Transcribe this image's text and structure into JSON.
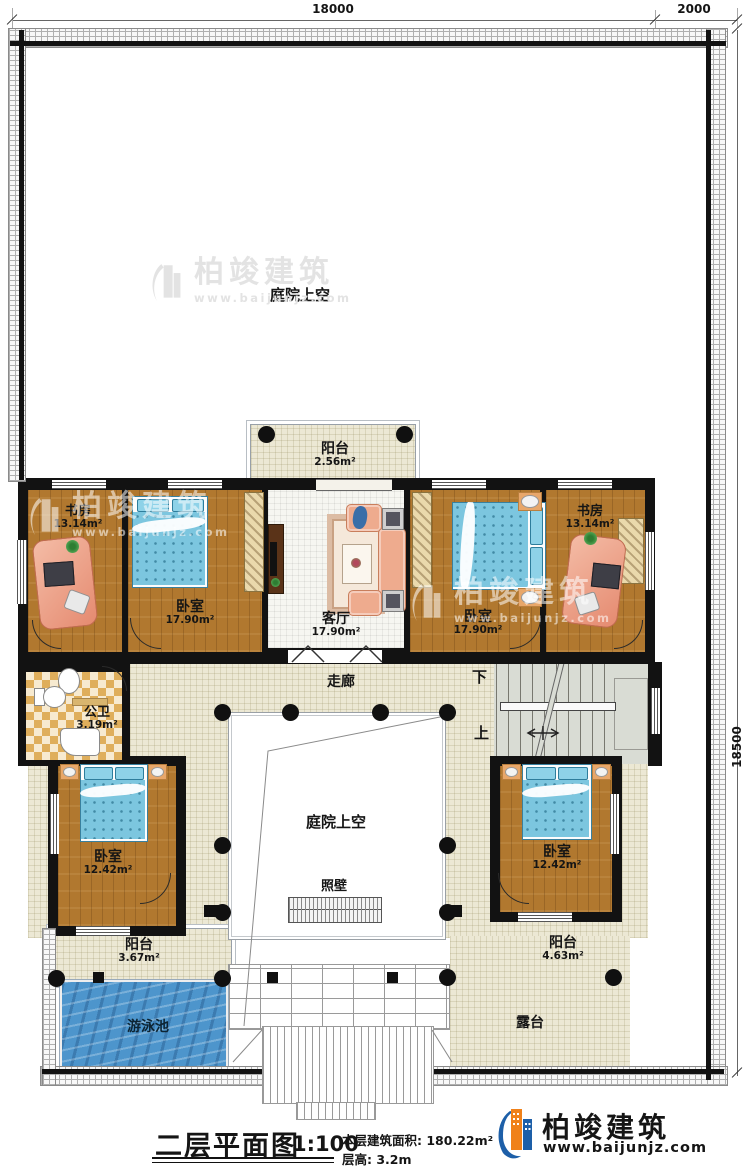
{
  "dimensions": {
    "top_main": "18000",
    "top_right": "2000",
    "right_side": "18500"
  },
  "watermark": {
    "brand": "柏竣建筑",
    "url": "www.baijunjz.com"
  },
  "rooms": {
    "courtyard_top": {
      "name": "庭院上空"
    },
    "balcony_top": {
      "name": "阳台",
      "area": "2.56m²"
    },
    "study_left": {
      "name": "书房",
      "area": "13.14m²"
    },
    "bedroom_left": {
      "name": "卧室",
      "area": "17.90m²"
    },
    "living": {
      "name": "客厅",
      "area": "17.90m²"
    },
    "bedroom_right": {
      "name": "卧室",
      "area": "17.90m²"
    },
    "study_right": {
      "name": "书房",
      "area": "13.14m²"
    },
    "bath": {
      "name": "公卫",
      "area": "3.19m²"
    },
    "corridor": {
      "name": "走廊"
    },
    "stair": {
      "down": "下",
      "up": "上"
    },
    "courtyard_center": {
      "name": "庭院上空"
    },
    "screen_wall": {
      "name": "照壁"
    },
    "bedroom_bl": {
      "name": "卧室",
      "area": "12.42m²"
    },
    "bedroom_br": {
      "name": "卧室",
      "area": "12.42m²"
    },
    "balcony_bl": {
      "name": "阳台",
      "area": "3.67m²"
    },
    "balcony_br": {
      "name": "阳台",
      "area": "4.63m²"
    },
    "pool": {
      "name": "游泳池"
    },
    "terrace": {
      "name": "露台"
    }
  },
  "titleblock": {
    "title": "二层平面图",
    "scale": "1:100",
    "area_label": "本层建筑面积:",
    "area_value": "180.22m²",
    "floor_height_label": "层高:",
    "floor_height_value": "3.2m"
  },
  "logo": {
    "brand": "柏竣建筑",
    "url": "www.baijunjz.com"
  },
  "colors": {
    "wall": "#121212",
    "wood_floor": "#b1782f",
    "beige_floor": "#ece8d4",
    "bed_blue": "#7cc6df",
    "sofa_salmon": "#eeab8e",
    "pool_blue": "#4d95cc",
    "stair_gray": "#d9dcd4",
    "logo_blue": "#1d5fa8",
    "logo_orange": "#f08119"
  }
}
